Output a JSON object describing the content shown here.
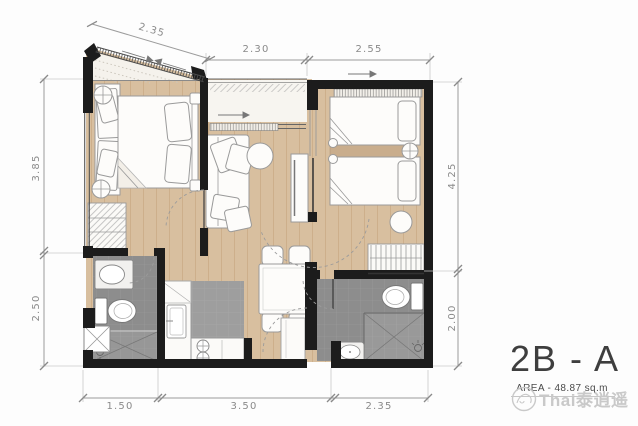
{
  "plan": {
    "title": "2B - A",
    "area_label": "AREA - 48.87 sq.m",
    "watermark_text": "Thai泰逍遥",
    "dimensions": {
      "diagonal": "2.35",
      "top": [
        "2.30",
        "2.55"
      ],
      "left": [
        "3.85",
        "2.50"
      ],
      "right": [
        "4.25",
        "2.00"
      ],
      "bottom": [
        "1.50",
        "3.50",
        "2.35"
      ]
    },
    "colors": {
      "wall": "#1c1c1c",
      "wood_floor": "#d8bf9f",
      "bath_tile": "#8d8d8d",
      "kitchen_tile": "#9e9e9e",
      "dimension_text": "#8a8a8a",
      "title_text": "#3e3e3e",
      "watermark": "#c9c9c9"
    }
  }
}
